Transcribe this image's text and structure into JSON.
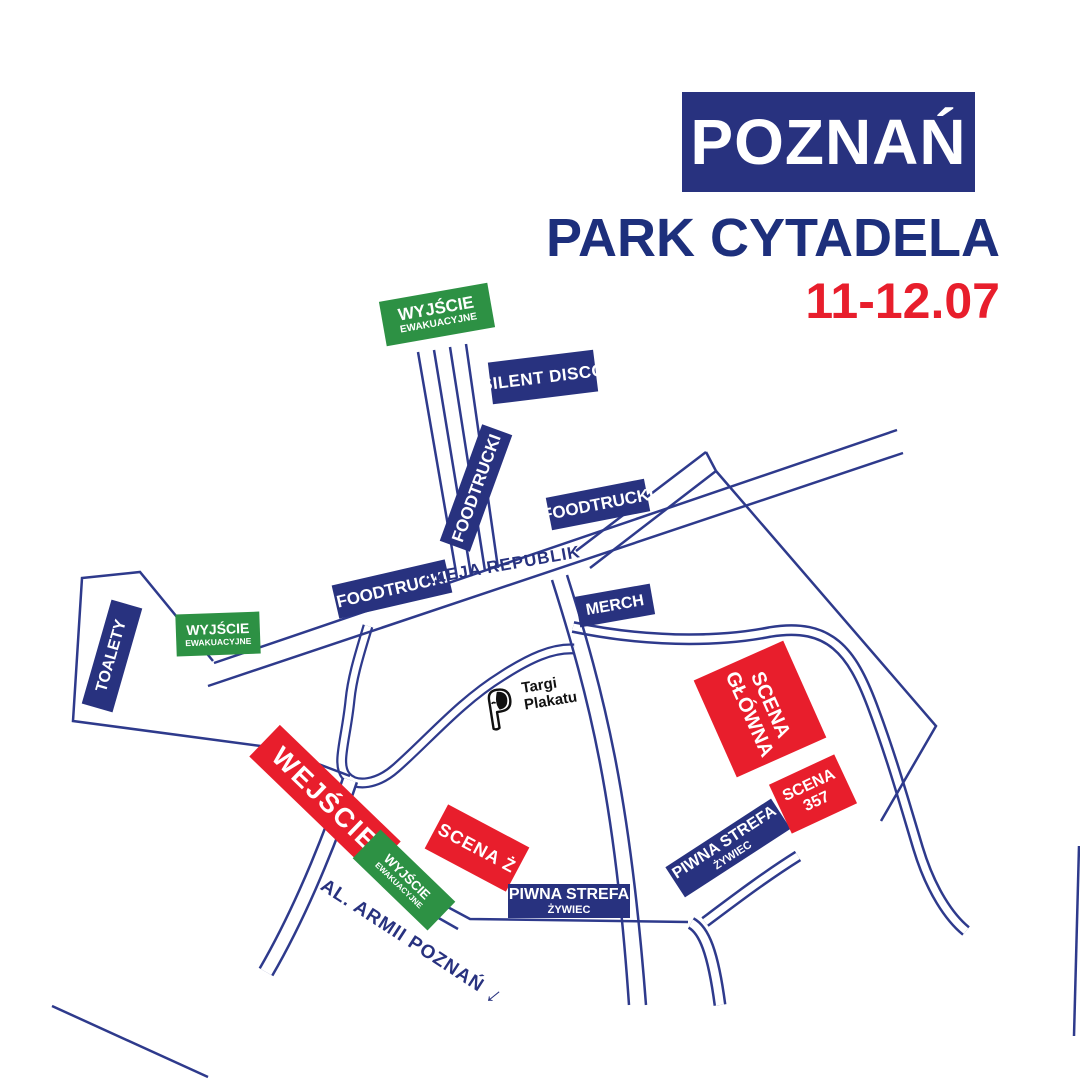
{
  "title": "Festival site map",
  "colors": {
    "navy_box": "#28327f",
    "line_navy": "#2e3a8c",
    "red": "#e81e2c",
    "green": "#2d9144",
    "white": "#ffffff",
    "ink": "#111111"
  },
  "header": {
    "city": "POZNAŃ",
    "venue": "PARK CYTADELA",
    "dates": "11-12.07"
  },
  "map": {
    "exit_sign": {
      "line1": "WYJŚCIE",
      "line2": "EWAKUACYJNE"
    },
    "labels": {
      "silent_disco": "SILENT DISCO",
      "foodtrucki": "FOODTRUCKI",
      "street": "ALEJA REPUBLIK",
      "merch": "MERCH",
      "toalety": "TOALETY",
      "entrance": "WEJŚCIE",
      "scena_z": "SCENA Ż",
      "scena_glowna": {
        "line1": "SCENA",
        "line2": "GŁÓWNA"
      },
      "scena_357": {
        "line1": "SCENA",
        "line2": "357"
      },
      "piwna": {
        "line1": "PIWNA STREFA",
        "line2": "ŻYWIEC"
      },
      "avenue": "AL. ARMII POZNAŃ",
      "arrow": "↓"
    },
    "logo": {
      "line1": "Targi",
      "line2": "Plakatu"
    }
  }
}
